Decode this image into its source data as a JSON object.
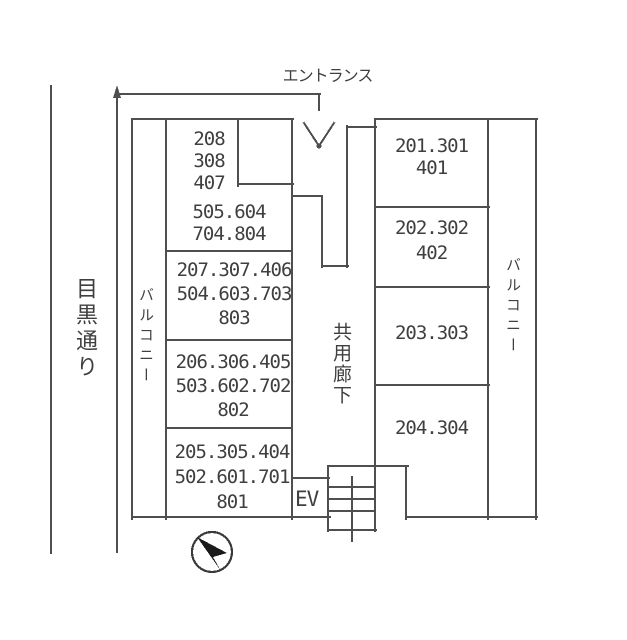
{
  "labels": {
    "entrance": "エントランス",
    "street": "目黒通り",
    "balcony_left": "バルコニー",
    "balcony_right": "バルコニー",
    "corridor": "共用廊下",
    "elevator": "EV"
  },
  "rooms": {
    "left": [
      {
        "lines": [
          "208",
          "308",
          "407"
        ]
      },
      {
        "lines": [
          "505.604",
          "704.804"
        ]
      },
      {
        "lines": [
          "207.307.406",
          "504.603.703",
          "803"
        ]
      },
      {
        "lines": [
          "206.306.405",
          "503.602.702",
          "802"
        ]
      },
      {
        "lines": [
          "205.305.404",
          "502.601.701",
          "801"
        ]
      }
    ],
    "right": [
      {
        "lines": [
          "201.301",
          "401"
        ]
      },
      {
        "lines": [
          "202.302",
          "402"
        ]
      },
      {
        "lines": [
          "203.303"
        ]
      },
      {
        "lines": [
          "204.304"
        ]
      }
    ]
  },
  "icons": {
    "entrance_arrow": "down-arrow-icon",
    "boundary_arrow": "up-arrow-icon",
    "compass": "compass-north-icon"
  },
  "colors": {
    "line": "#4f4f4f",
    "text": "#3f3f3f",
    "background": "#ffffff"
  }
}
